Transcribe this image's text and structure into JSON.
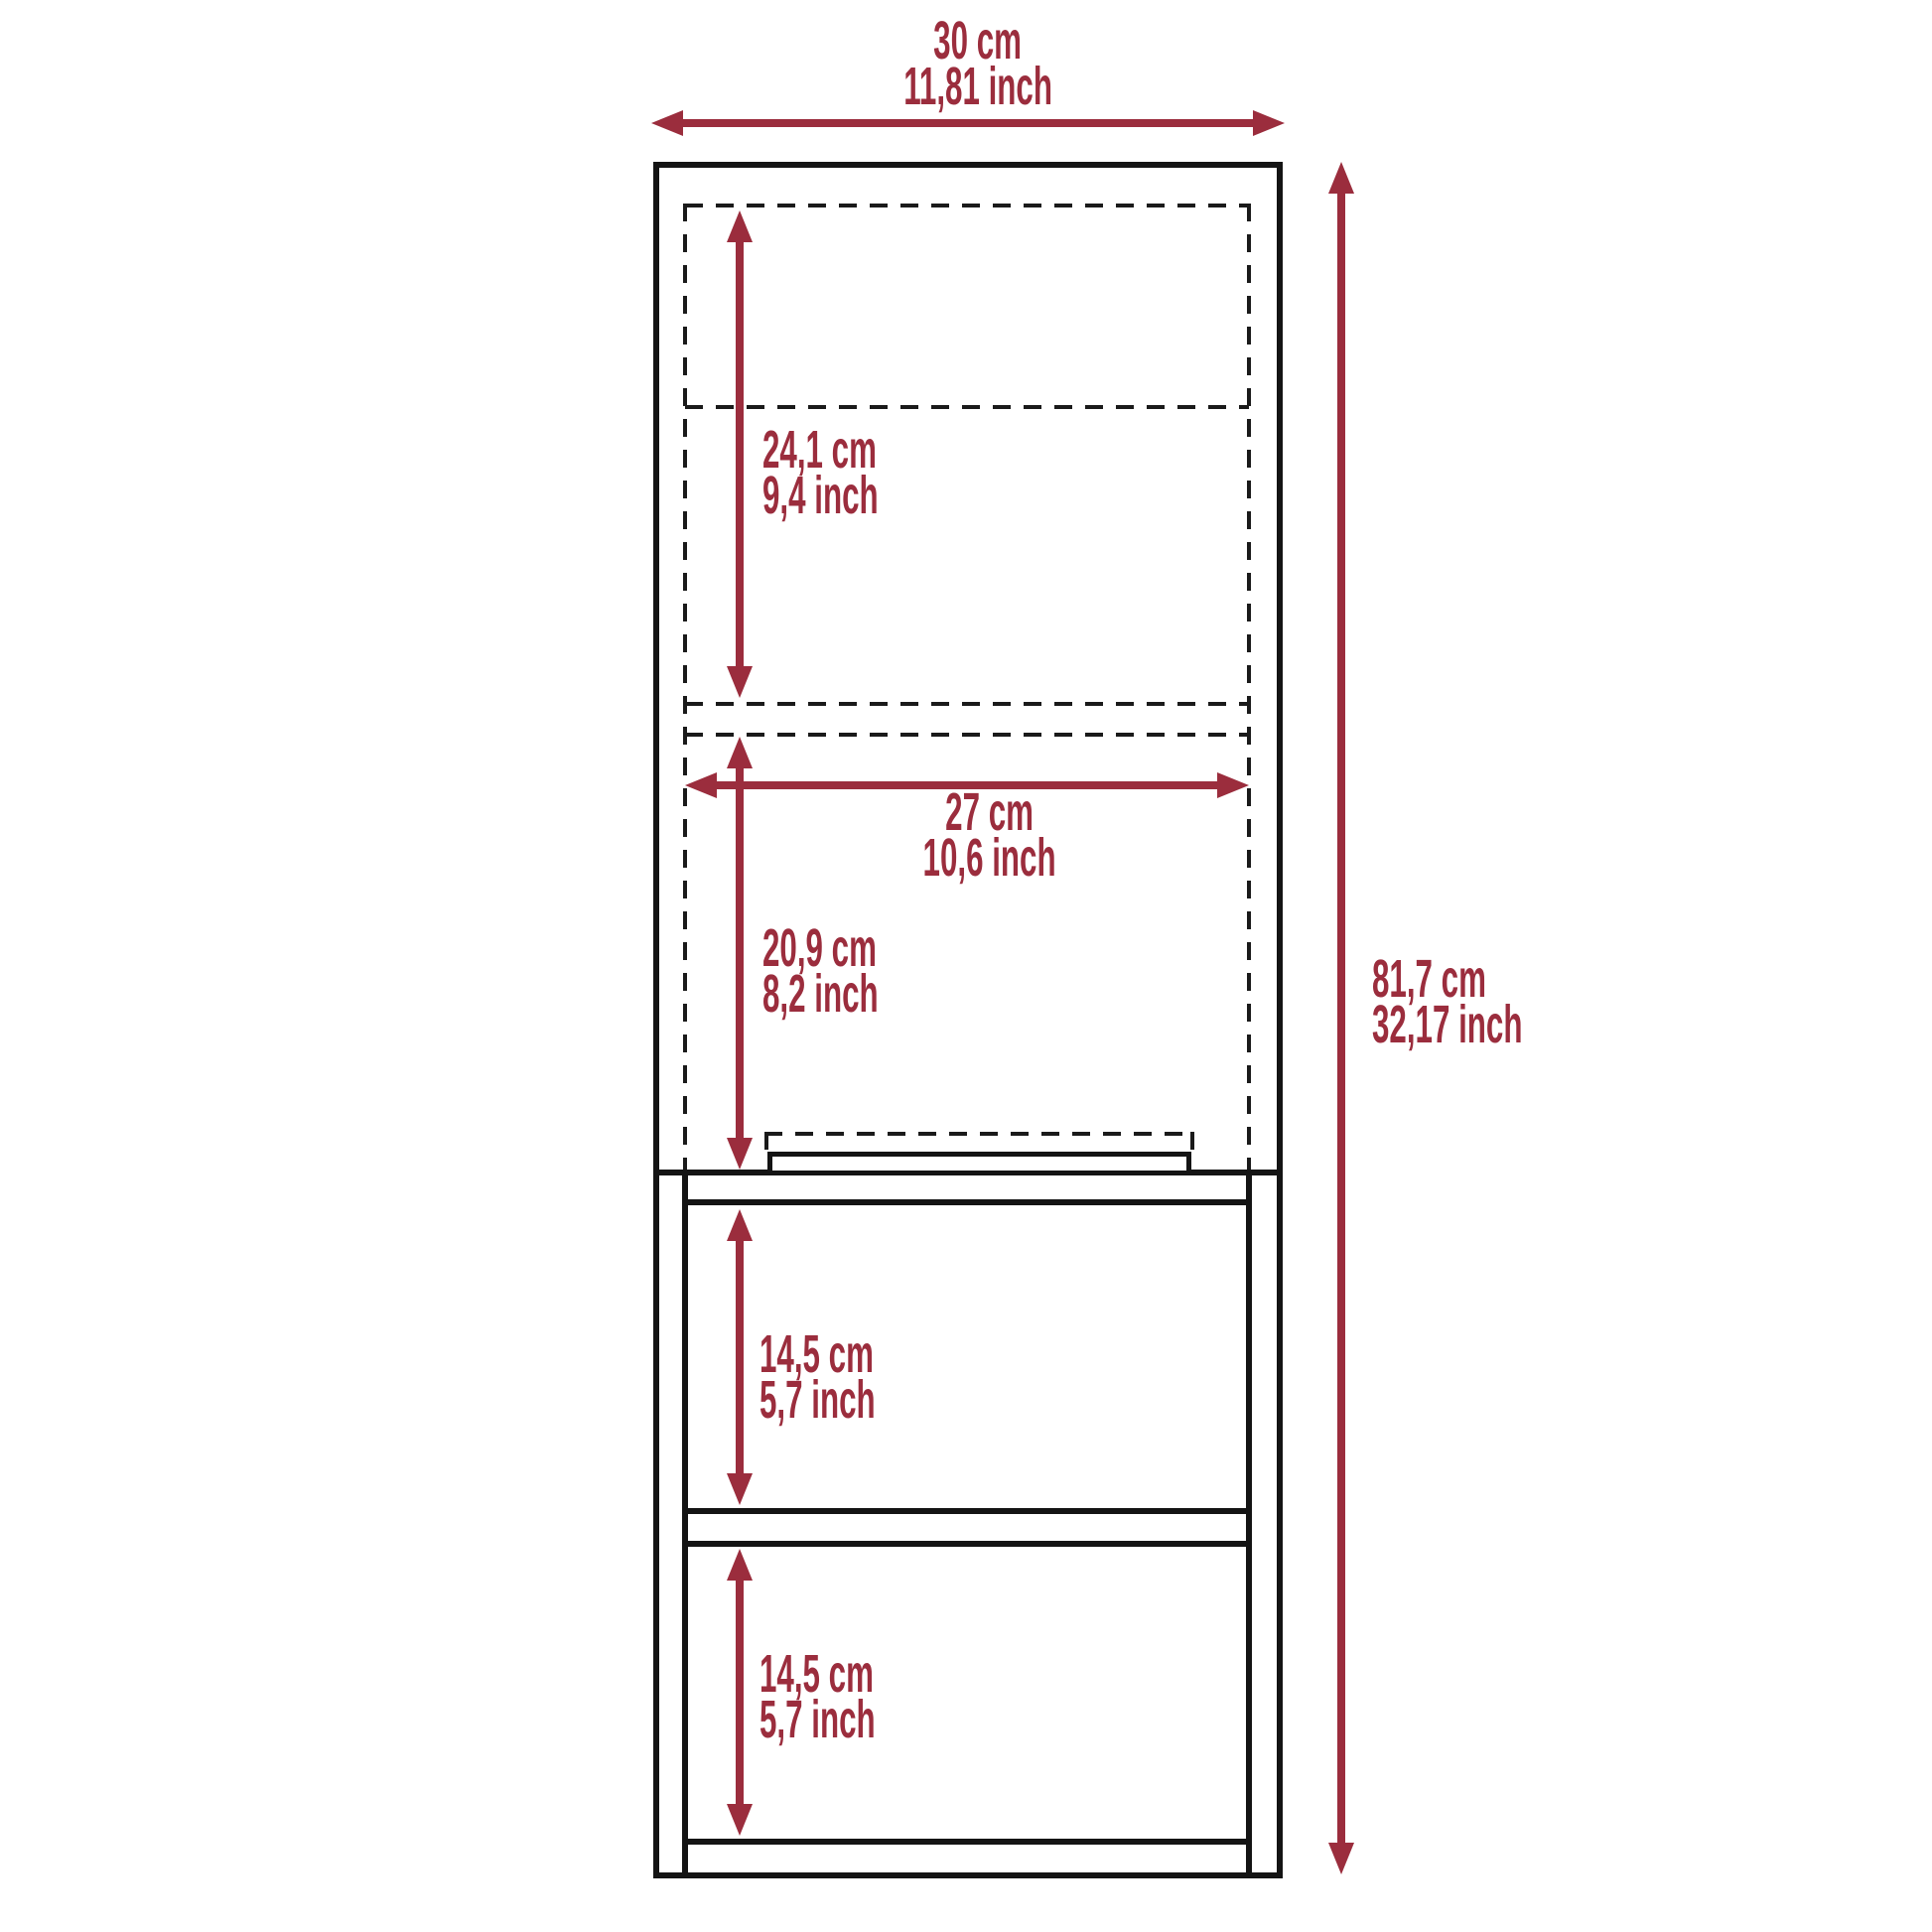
{
  "figure": {
    "type": "furniture-dimension-diagram",
    "subject": "tall bathroom cabinet with door and two open shelves",
    "background": "#ffffff"
  },
  "colors": {
    "dimension_red": "#9b2d3d",
    "outline_black": "#141414"
  },
  "dimensions": {
    "overall_width": {
      "cm": "30 cm",
      "inch": "11,81 inch"
    },
    "overall_height": {
      "cm": "81,7 cm",
      "inch": "32,17 inch"
    },
    "upper_compartment": {
      "cm": "24,1 cm",
      "inch": "9,4 inch"
    },
    "inner_width": {
      "cm": "27 cm",
      "inch": "10,6 inch"
    },
    "lower_compartment": {
      "cm": "20,9 cm",
      "inch": "8,2 inch"
    },
    "open_shelf_top": {
      "cm": "14,5 cm",
      "inch": "5,7 inch"
    },
    "open_shelf_bottom": {
      "cm": "14,5 cm",
      "inch": "5,7 inch"
    }
  }
}
